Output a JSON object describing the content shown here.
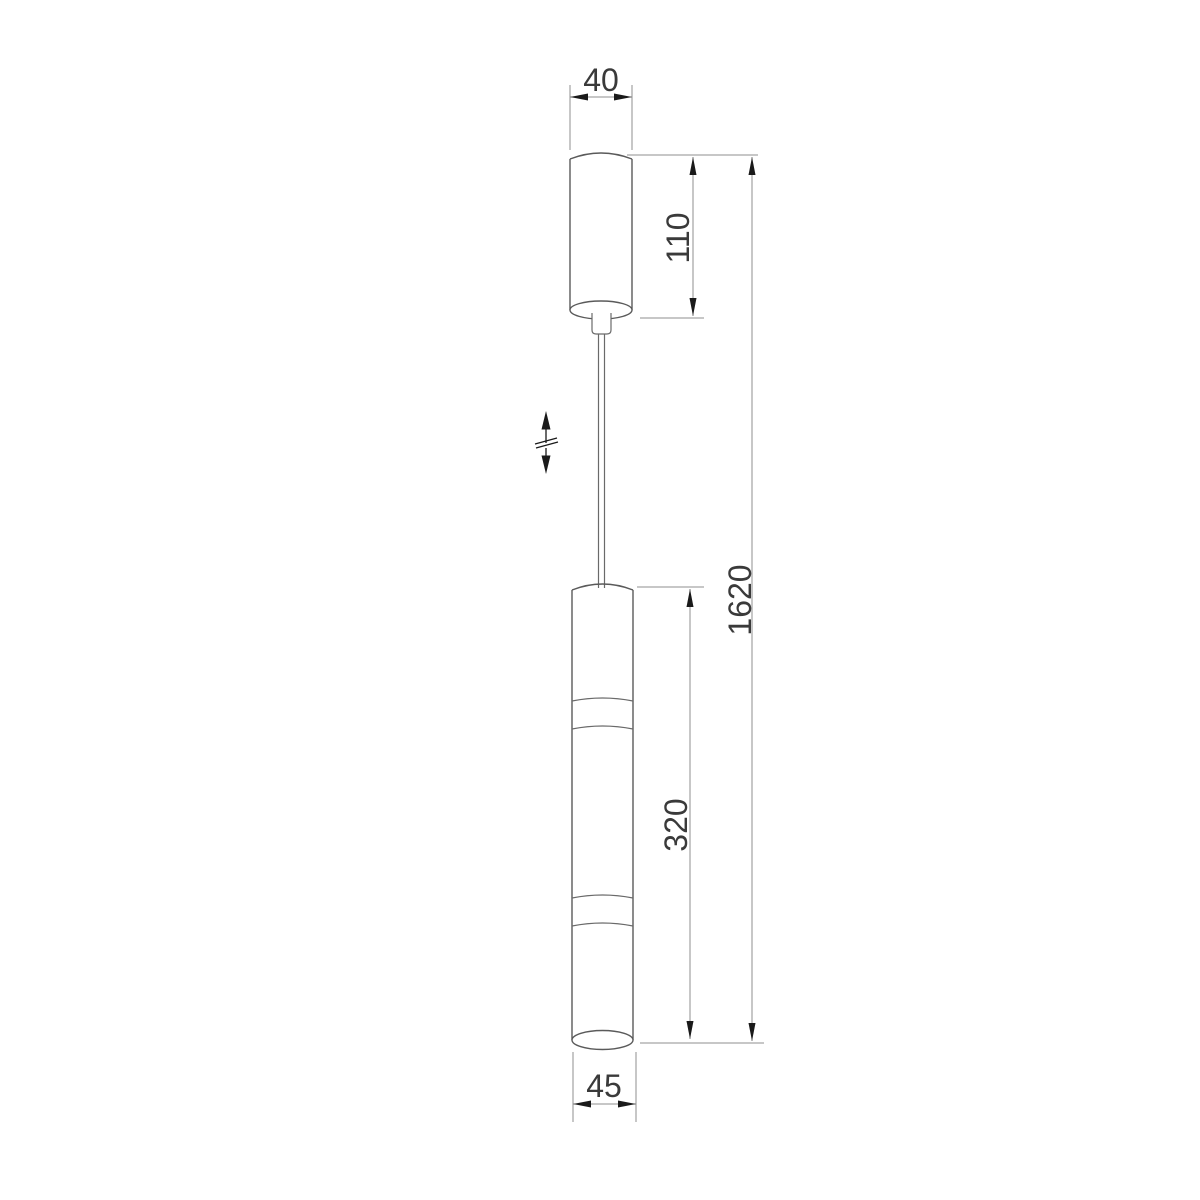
{
  "drawing": {
    "kind": "technical dimension drawing",
    "subject": "pendant cylinder lamp with ceiling canopy and adjustable cable",
    "background_color": "#ffffff",
    "line_colors": {
      "object_outline": "#5a5a5a",
      "dimension_lines": "#8f8f8f",
      "arrowheads": "#1a1a1a",
      "labels": "#3a3a3a"
    },
    "labels": {
      "canopy_width": "40",
      "canopy_height": "110",
      "overall_height": "1620",
      "body_height": "320",
      "body_width": "45"
    }
  }
}
